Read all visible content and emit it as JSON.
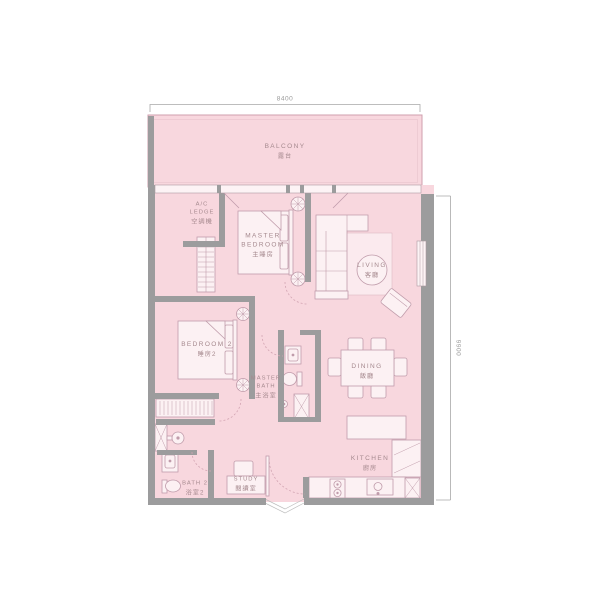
{
  "plan": {
    "type": "residential-floor-plan",
    "rooms": {
      "balcony": {
        "en": "BALCONY",
        "zh": "露台"
      },
      "ac_ledge": {
        "en1": "A/C",
        "en2": "LEDGE",
        "zh": "空調機"
      },
      "master_bedroom": {
        "en1": "MASTER",
        "en2": "BEDROOM",
        "zh": "主睡房"
      },
      "living": {
        "en": "LIVING",
        "zh": "客廳"
      },
      "bedroom2": {
        "en": "BEDROOM 2",
        "zh": "睡房2"
      },
      "master_bath": {
        "en1": "MASTER",
        "en2": "BATH",
        "zh": "主浴室"
      },
      "dining": {
        "en": "DINING",
        "zh": "飯廳"
      },
      "kitchen": {
        "en": "KITCHEN",
        "zh": "廚房"
      },
      "bath2": {
        "en": "BATH 2",
        "zh": "浴室2"
      },
      "study": {
        "en": "STUDY",
        "zh": "閱讀室"
      }
    },
    "dimensions": {
      "top": "8400",
      "right": "9900"
    },
    "colors": {
      "floor_fill": "#f8d7de",
      "wall": "#9c9c9d",
      "furniture_fill": "#fcf1f3",
      "furniture_outline": "#c09cab",
      "rug_fill": "#fbeaee",
      "label_text": "#a5898e",
      "dimension_line": "#a8a8a8"
    }
  }
}
